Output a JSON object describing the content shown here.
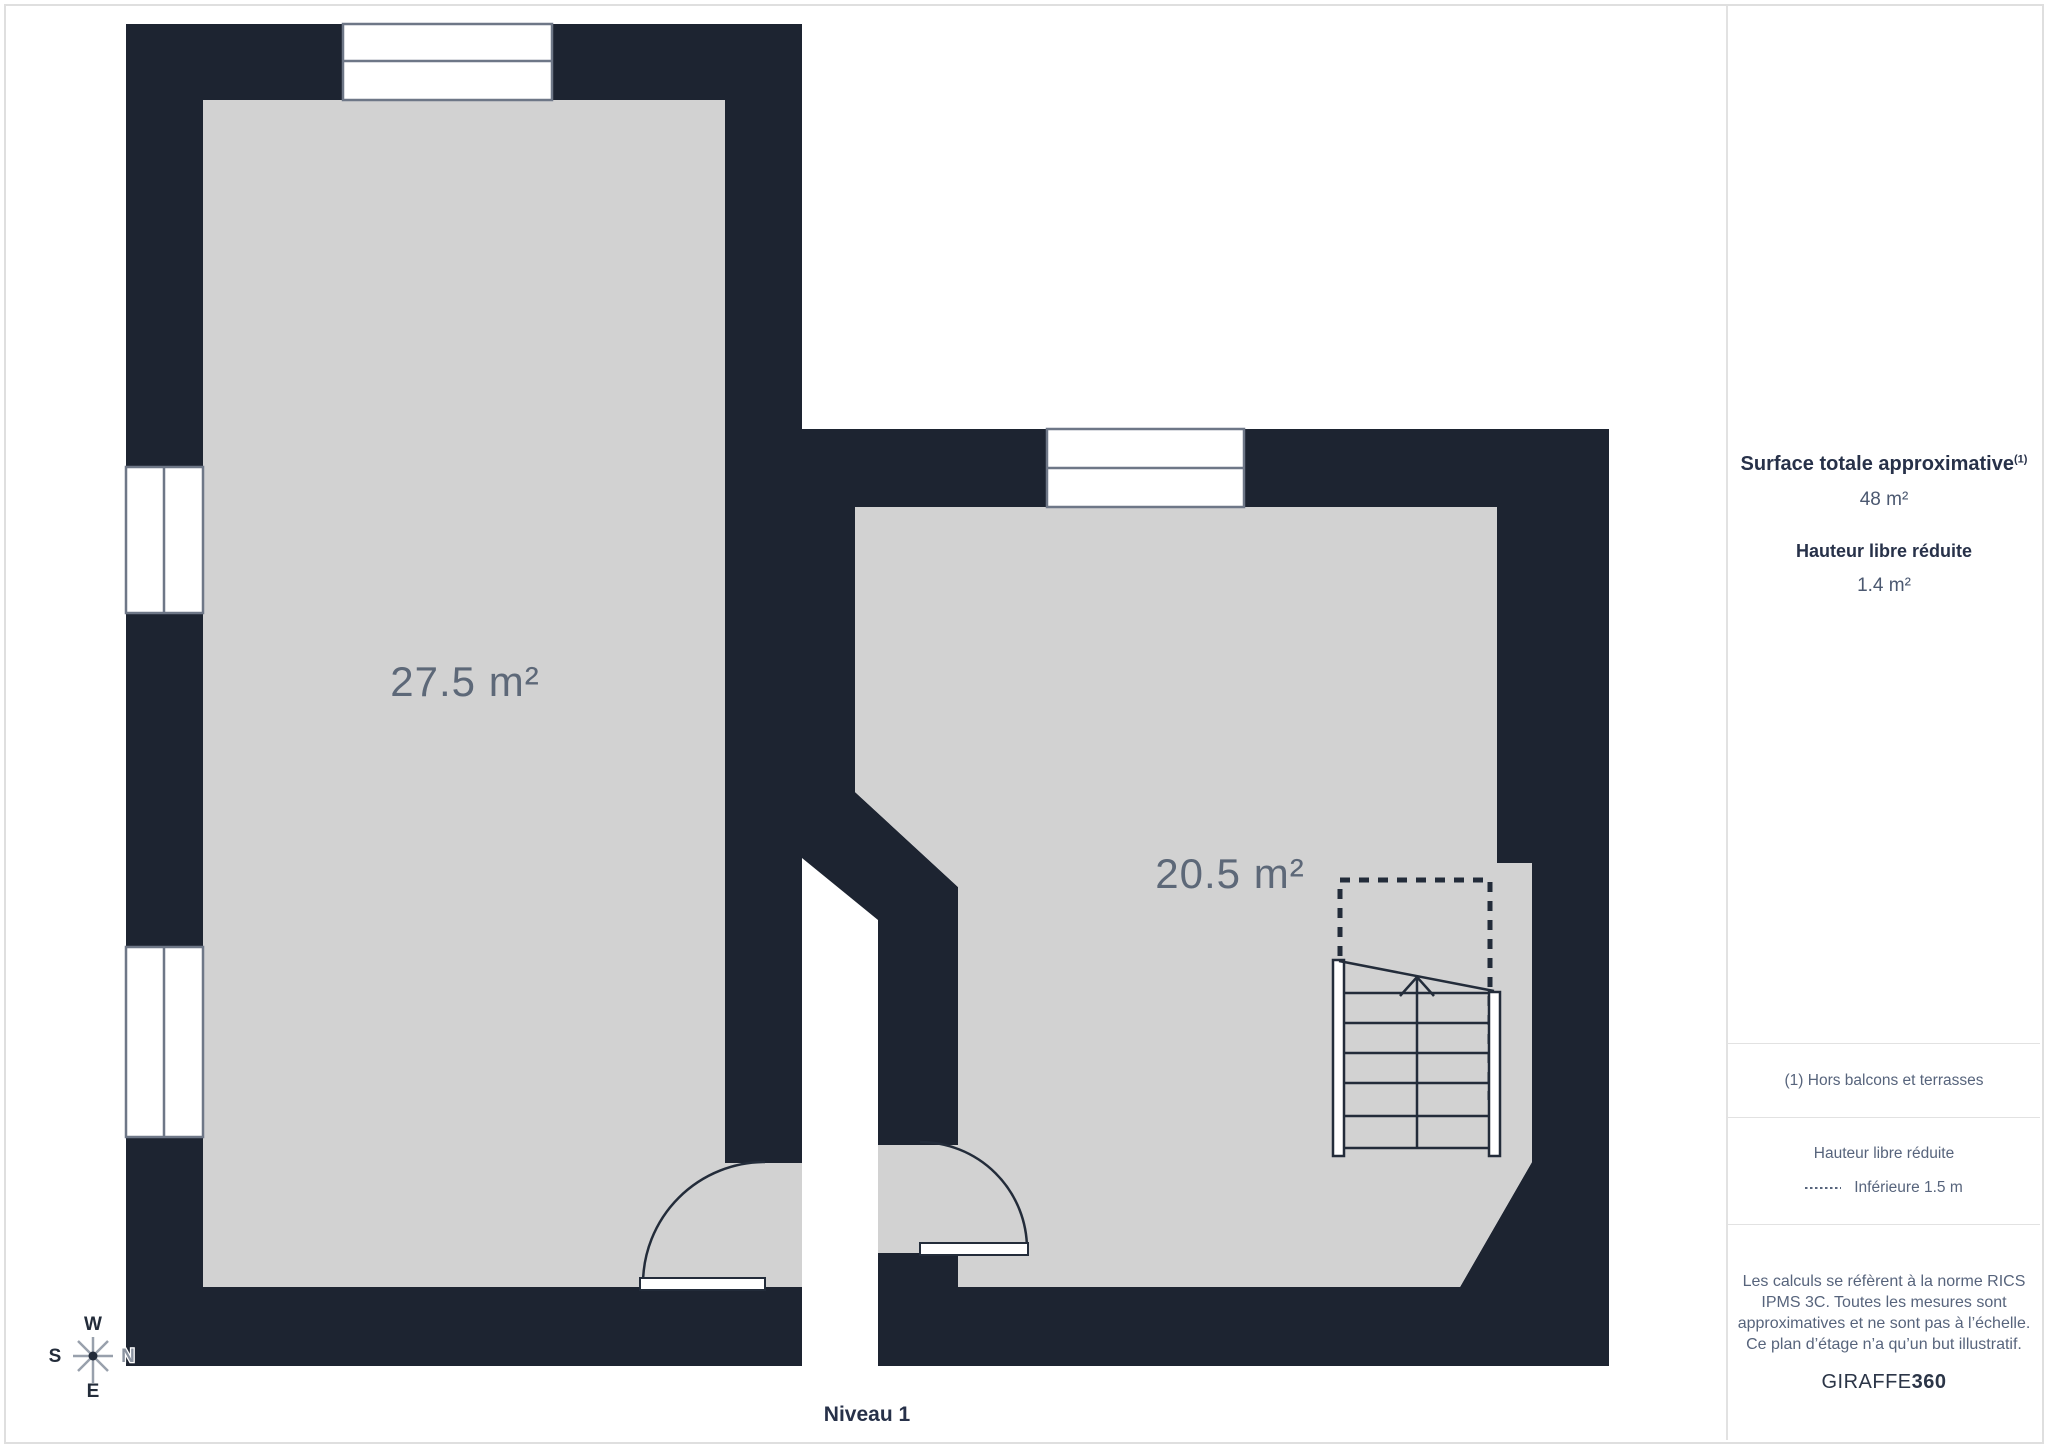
{
  "colors": {
    "wall": "#1d2431",
    "floor": "#d2d2d2",
    "window-stroke": "#6e7787",
    "line": "#232c3a",
    "room-label": "#5d6878",
    "heading-text": "#273149",
    "value-text": "#4b5870",
    "muted-text": "#57647c",
    "page-border": "#dfdfdf",
    "divider": "#e2e2e2"
  },
  "plan": {
    "level_label": "Niveau 1",
    "rooms": [
      {
        "area_label": "27.5 m²"
      },
      {
        "area_label": "20.5 m²"
      }
    ],
    "compass": {
      "top": "W",
      "left": "S",
      "right": "N",
      "bottom": "E"
    }
  },
  "sidebar": {
    "total_area": {
      "heading": "Surface totale approximative",
      "footnote_marker": "(1)",
      "value": "48 m²"
    },
    "reduced_height": {
      "heading": "Hauteur libre réduite",
      "value": "1.4 m²"
    },
    "footnote": "(1) Hors balcons et terrasses",
    "legend": {
      "heading": "Hauteur libre réduite",
      "item": "Inférieure 1.5 m"
    },
    "disclaimer": "Les calculs se réfèrent à la norme RICS IPMS 3C. Toutes les mesures sont approximatives et ne sont pas à l’échelle. Ce plan d’étage n’a qu’un but illustratif.",
    "brand": {
      "name": "GIRAFFE",
      "suffix": "360"
    }
  }
}
